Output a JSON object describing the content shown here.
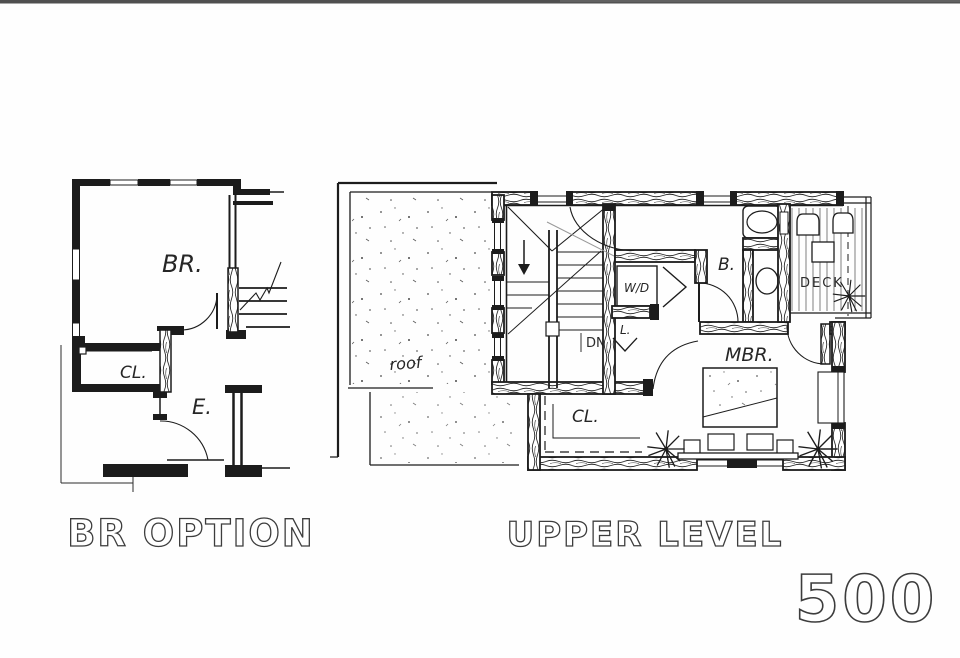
{
  "colors": {
    "paper": "#fefefe",
    "ink": "#1c1c1c",
    "pencil": "#999999",
    "scan_edge": "#4f4f4f"
  },
  "left_plan": {
    "title": "BR OPTION",
    "labels": {
      "bedroom": "BR.",
      "closet": "CL.",
      "entry": "E."
    }
  },
  "upper_level": {
    "title": "UPPER LEVEL",
    "labels": {
      "roof": "roof",
      "down": "DN",
      "washer_dryer": "W/D",
      "linen": "L.",
      "bath": "B.",
      "deck": "DECK",
      "master_bedroom": "MBR.",
      "closet": "CL."
    }
  },
  "plan_number": "500"
}
